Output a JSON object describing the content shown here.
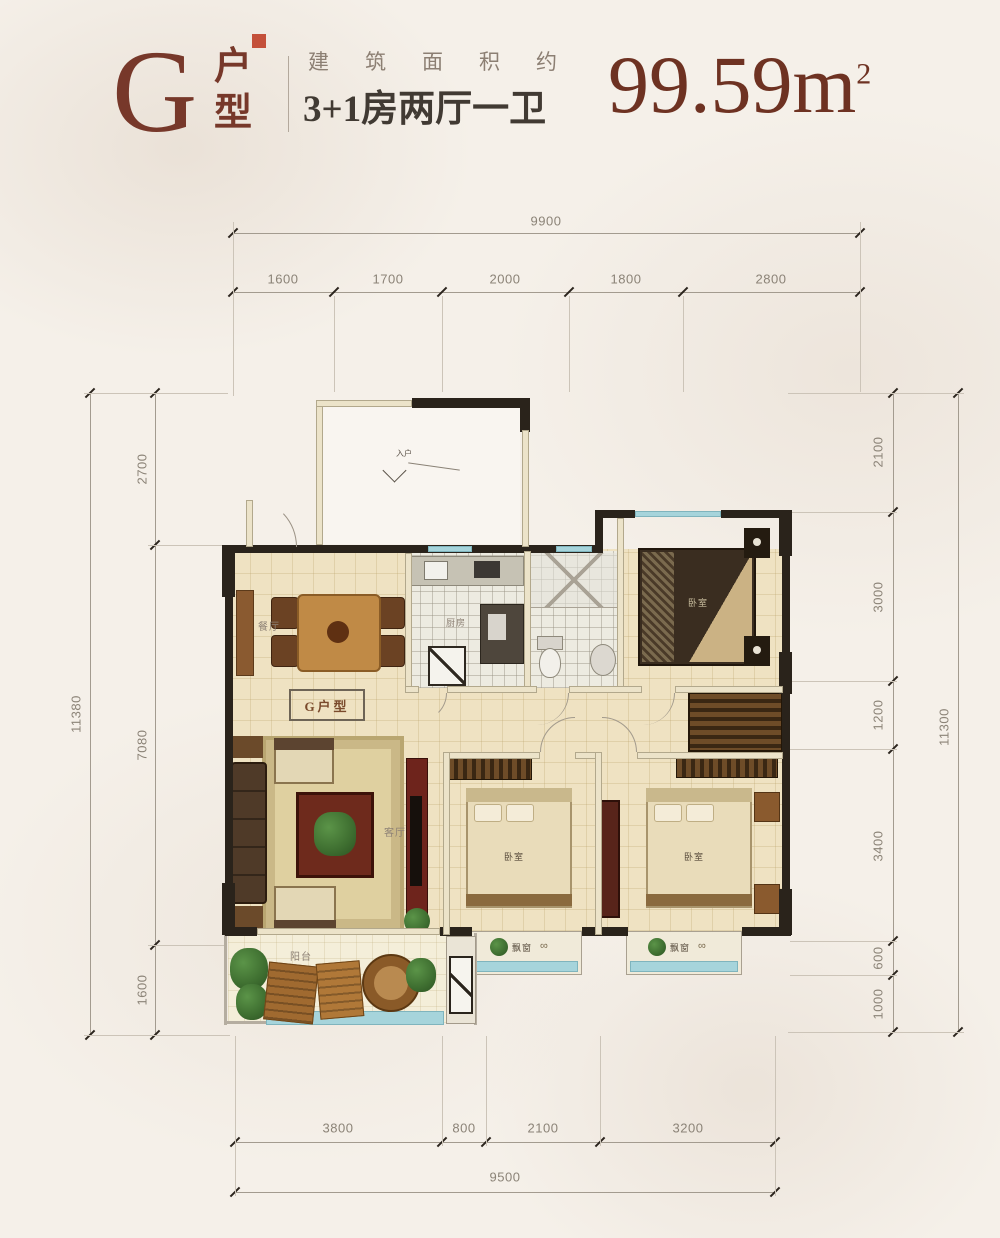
{
  "header": {
    "unit_letter": "G",
    "unit_type_top": "户",
    "unit_type_bottom": "型",
    "area_label": "建筑面积约",
    "layout_desc": "3+1房两厅一卫",
    "area_value": "99.59m",
    "area_sup": "2"
  },
  "dims": {
    "top_total": "9900",
    "top_segments": [
      "1600",
      "1700",
      "2000",
      "1800",
      "2800"
    ],
    "bottom_segments": [
      "3800",
      "800",
      "2100",
      "3200"
    ],
    "bottom_total": "9500",
    "left_segments": [
      "2700",
      "7080",
      "1600"
    ],
    "left_total": "11380",
    "right_segments": [
      "2100",
      "3000",
      "1200",
      "3400",
      "600",
      "1000"
    ],
    "right_total": "11300"
  },
  "plan": {
    "unit_box_label": "G户型",
    "labels": {
      "dining": "餐厅",
      "kitchen": "厨房",
      "living": "客厅",
      "bedroom": "卧室",
      "balcony": "阳台",
      "bay_window": "飘窗",
      "entry": "入户"
    }
  },
  "colors": {
    "accent": "#77382a",
    "dim_text": "#8b8377",
    "wall": "#2a231b",
    "window": "#a6d4db",
    "floor": "#efe2c2"
  }
}
